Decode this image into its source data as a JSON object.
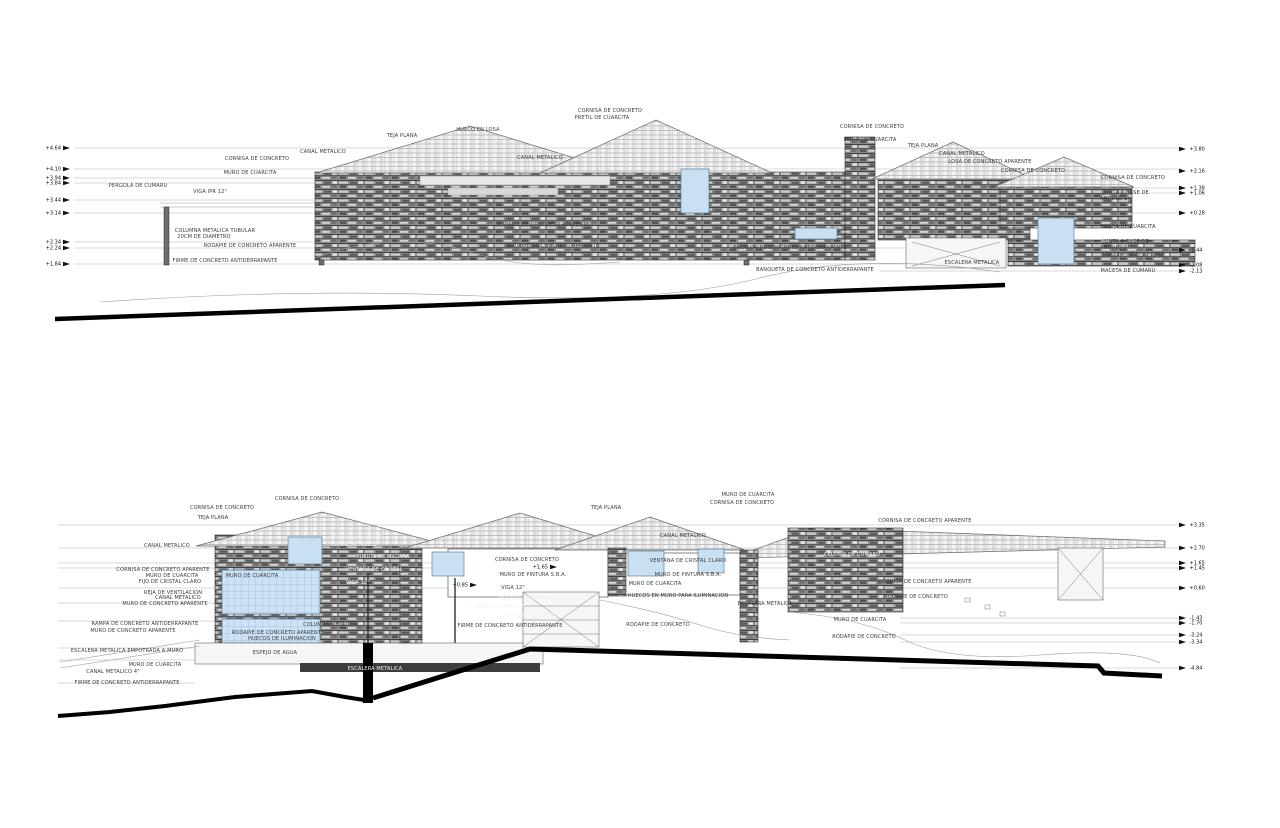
{
  "document": {
    "type": "architectural elevation and section drawings",
    "language": "es",
    "sheet_background": "#ffffff"
  },
  "colors": {
    "glazing": "#c9dff2",
    "water": "#cde2f4",
    "stone_dark": "#5a5a5a",
    "ground_line": "#000000",
    "label_text": "#3a3a3a"
  },
  "drawing1": {
    "name": "upper-elevation",
    "labels": [
      {
        "text": "CORNISA DE CONCRETO",
        "x": 257,
        "y": 160
      },
      {
        "text": "CANAL METALICO",
        "x": 323,
        "y": 153
      },
      {
        "text": "TEJA PLANA",
        "x": 402,
        "y": 137
      },
      {
        "text": "HUECO EN LOSA",
        "x": 478,
        "y": 131
      },
      {
        "text": "CORNISA DE CONCRETO",
        "x": 610,
        "y": 112
      },
      {
        "text": "PRETIL DE CUARCITA",
        "x": 602,
        "y": 119
      },
      {
        "text": "CANAL METALICO",
        "x": 540,
        "y": 159
      },
      {
        "text": "MURO DE CUARCITA",
        "x": 250,
        "y": 174
      },
      {
        "text": "PERGOLA DE CUMARU",
        "x": 138,
        "y": 187
      },
      {
        "text": "VIGA IPR 12\"",
        "x": 210,
        "y": 193
      },
      {
        "text": "COLUMNA METALICA TUBULAR",
        "x": 215,
        "y": 232
      },
      {
        "text": "20CM DE DIAMETRO",
        "x": 204,
        "y": 238
      },
      {
        "text": "RODAPIE DE CONCRETO APARENTE",
        "x": 250,
        "y": 247
      },
      {
        "text": "FIRME DE CONCRETO ANTIDERRAPANTE",
        "x": 225,
        "y": 262
      },
      {
        "text": "RODAPIE DE CONCRETO APARENTE",
        "x": 543,
        "y": 226
      },
      {
        "text": "RODAPIE DE CONCRETO APARENTE",
        "x": 553,
        "y": 247
      },
      {
        "text": "ESCALON DE CONCRETO ANTIDERRAPANTE",
        "x": 790,
        "y": 249
      },
      {
        "text": "BANQUETA DE CONCRETO ANTIDERRAPANTE",
        "x": 815,
        "y": 271
      },
      {
        "text": "CORNISA DE CONCRETO",
        "x": 872,
        "y": 128
      },
      {
        "text": "MURO DE CUARCITA",
        "x": 870,
        "y": 141
      },
      {
        "text": "TEJA PLANA",
        "x": 923,
        "y": 147
      },
      {
        "text": "CANAL METALICO",
        "x": 962,
        "y": 155
      },
      {
        "text": "LOSA DE CONCRETO APARENTE",
        "x": 990,
        "y": 163
      },
      {
        "text": "CORNISA DE CONCRETO",
        "x": 1033,
        "y": 172
      },
      {
        "text": "CORNISA DE CONCRETO",
        "x": 1133,
        "y": 179
      },
      {
        "text": "JUNTA A BASE DE",
        "x": 1126,
        "y": 194
      },
      {
        "text": "ANGULO 1\"",
        "x": 1115,
        "y": 200
      },
      {
        "text": "BANDA DE CUARCITA",
        "x": 1128,
        "y": 228
      },
      {
        "text": "JUNTA A BASE DE",
        "x": 1126,
        "y": 243
      },
      {
        "text": "ANGULO 1\"",
        "x": 1115,
        "y": 249
      },
      {
        "text": "RODAPIE DE CONCRETO",
        "x": 1133,
        "y": 257
      },
      {
        "text": "MACETA DE CUMARU",
        "x": 1128,
        "y": 272
      },
      {
        "text": "ESCALERA METALICA",
        "x": 972,
        "y": 264
      }
    ],
    "levels_left": [
      {
        "value": "+4.64",
        "y": 148
      },
      {
        "value": "+4.10",
        "y": 169
      },
      {
        "value": "+3.94",
        "y": 178
      },
      {
        "value": "+3.84",
        "y": 183
      },
      {
        "value": "+3.44",
        "y": 200
      },
      {
        "value": "+3.14",
        "y": 213
      },
      {
        "value": "+2.34",
        "y": 242
      },
      {
        "value": "+2.24",
        "y": 248
      },
      {
        "value": "+1.84",
        "y": 264
      }
    ],
    "levels_right": [
      {
        "value": "+3.80",
        "y": 149
      },
      {
        "value": "+2.16",
        "y": 171
      },
      {
        "value": "+1.38",
        "y": 188
      },
      {
        "value": "+1.06",
        "y": 193
      },
      {
        "value": "+0.28",
        "y": 213
      },
      {
        "value": "-1.44",
        "y": 250
      },
      {
        "value": "-2.08",
        "y": 265
      },
      {
        "value": "-2.13",
        "y": 271
      }
    ]
  },
  "drawing2": {
    "name": "lower-section",
    "labels": [
      {
        "text": "CORNISA DE CONCRETO",
        "x": 307,
        "y": 500
      },
      {
        "text": "CORNISA DE CONCRETO",
        "x": 222,
        "y": 509
      },
      {
        "text": "TEJA PLANA",
        "x": 213,
        "y": 519
      },
      {
        "text": "MURO DE CUARCITA",
        "x": 748,
        "y": 496
      },
      {
        "text": "CORNISA DE CONCRETO",
        "x": 742,
        "y": 504
      },
      {
        "text": "TEJA PLANA",
        "x": 606,
        "y": 509
      },
      {
        "text": "CANAL METALICO",
        "x": 683,
        "y": 537
      },
      {
        "text": "CANAL METALICO",
        "x": 167,
        "y": 547
      },
      {
        "text": "CORNISA DE CONCRETO APARENTE",
        "x": 925,
        "y": 522
      },
      {
        "text": "CORNISA DE CONCRETO APARENTE",
        "x": 163,
        "y": 571
      },
      {
        "text": "MURO DE CUARCITA",
        "x": 172,
        "y": 577
      },
      {
        "text": "FIJO DE CRISTAL CLARO",
        "x": 170,
        "y": 583
      },
      {
        "text": "REJA DE VENTILACION",
        "x": 173,
        "y": 594
      },
      {
        "text": "CANAL METALICO",
        "x": 178,
        "y": 599
      },
      {
        "text": "MURO DE CONCRETO APARENTE",
        "x": 165,
        "y": 605
      },
      {
        "text": "RAMPA DE CONCRETO ANTIDERRAPANTE",
        "x": 145,
        "y": 625
      },
      {
        "text": "MURO DE CONCRETO APARENTE",
        "x": 133,
        "y": 632
      },
      {
        "text": "ESCALERA METALICA EMPOTRADA A MURO",
        "x": 127,
        "y": 652
      },
      {
        "text": "MURO DE CUARCITA",
        "x": 155,
        "y": 666
      },
      {
        "text": "CANAL METALICO 4\"",
        "x": 113,
        "y": 673
      },
      {
        "text": "FIRME DE CONCRETO ANTIDERRAPANTE",
        "x": 127,
        "y": 684
      },
      {
        "text": "MURO DE CUARCITA",
        "x": 252,
        "y": 577
      },
      {
        "text": "RODAPIE DE CONCRETO APARENTE",
        "x": 278,
        "y": 634
      },
      {
        "text": "HUECOS DE ILUMINACION",
        "x": 282,
        "y": 640
      },
      {
        "text": "COLUMNA METALICA",
        "x": 330,
        "y": 626
      },
      {
        "text": "ESPEJO DE AGUA",
        "x": 275,
        "y": 654
      },
      {
        "text": "ESCALERA METALICA",
        "x": 375,
        "y": 670,
        "inv": true
      },
      {
        "text": "MURO DE CUARCITA",
        "x": 357,
        "y": 539,
        "inv": true
      },
      {
        "text": "CANAL METALICO",
        "x": 354,
        "y": 546,
        "inv": true
      },
      {
        "text": "PUERTA DE MADERA",
        "x": 383,
        "y": 558,
        "inv": true
      },
      {
        "text": "VENTANA DE CRISTAL",
        "x": 374,
        "y": 571,
        "inv": true
      },
      {
        "text": "VIGA 12\"",
        "x": 358,
        "y": 584,
        "inv": true
      },
      {
        "text": "CORNISA DE CONCRETO",
        "x": 527,
        "y": 561
      },
      {
        "text": "MURO DE PINTURA S.B.A.",
        "x": 533,
        "y": 576
      },
      {
        "text": "VIGA 12\"",
        "x": 513,
        "y": 589
      },
      {
        "text": "MURO DE CUARCITA",
        "x": 525,
        "y": 600,
        "inv": true
      },
      {
        "text": "COLUMNA METALICA",
        "x": 498,
        "y": 608,
        "inv": true
      },
      {
        "text": "PUERTA DE CEDRO",
        "x": 533,
        "y": 617,
        "inv": true
      },
      {
        "text": "FIRME DE CONCRETO ANTIDERRAPANTE",
        "x": 510,
        "y": 627
      },
      {
        "text": "VENTANA DE CRISTAL CLARO",
        "x": 688,
        "y": 562
      },
      {
        "text": "MURO DE PINTURA S.B.A.",
        "x": 688,
        "y": 576
      },
      {
        "text": "MURO DE CUARCITA",
        "x": 655,
        "y": 585
      },
      {
        "text": "HUECOS EN MURO PARA ILUMINACION",
        "x": 678,
        "y": 597
      },
      {
        "text": "ESCALERA METALICA",
        "x": 765,
        "y": 605
      },
      {
        "text": "RODAPIE DE CONCRETO",
        "x": 658,
        "y": 626
      },
      {
        "text": "CELOSIA DE CUMARU",
        "x": 852,
        "y": 556,
        "inv": true
      },
      {
        "text": "CORNISA DE CONCRETO APARENTE",
        "x": 925,
        "y": 583
      },
      {
        "text": "RODAPIE DE CONCRETO",
        "x": 916,
        "y": 598
      },
      {
        "text": "MURO DE CUARCITA",
        "x": 860,
        "y": 621
      },
      {
        "text": "RODAPIE DE CONCRETO",
        "x": 864,
        "y": 638
      }
    ],
    "levels_right": [
      {
        "value": "+3.35",
        "y": 525
      },
      {
        "value": "+2.70",
        "y": 548
      },
      {
        "value": "+1.65",
        "y": 563
      },
      {
        "value": "+1.45",
        "y": 568
      },
      {
        "value": "+0.60",
        "y": 588
      },
      {
        "value": "-1.43",
        "y": 618
      },
      {
        "value": "-1.70",
        "y": 623
      },
      {
        "value": "-3.24",
        "y": 635
      },
      {
        "value": "-3.34",
        "y": 642
      },
      {
        "value": "-4.84",
        "y": 668
      }
    ],
    "levels_mid": [
      {
        "value": "+1.65",
        "x": 557,
        "y": 567
      },
      {
        "value": "+0.85",
        "x": 477,
        "y": 585
      }
    ]
  }
}
